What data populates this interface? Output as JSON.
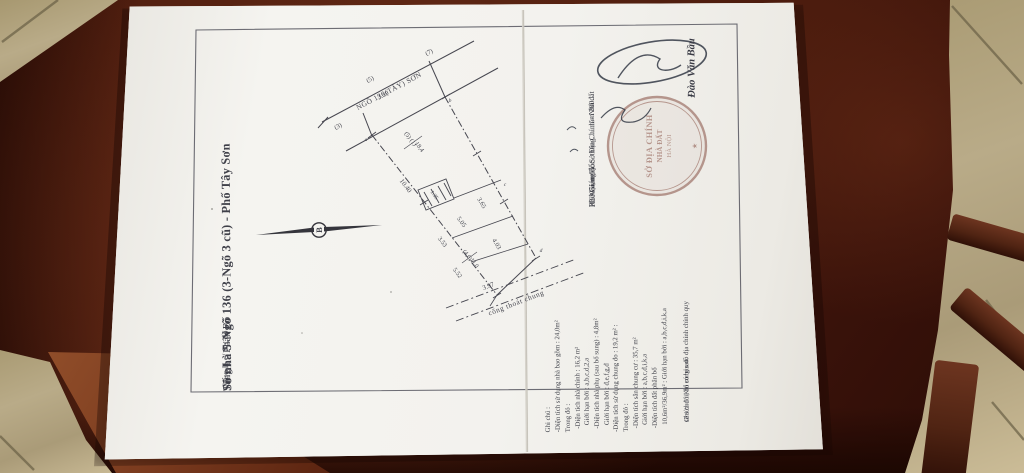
{
  "colors": {
    "table_wood": "#54210f",
    "tile_floor": "#b3a584",
    "paper": "#f4f3ee",
    "print_ink": "#3f4049",
    "handwriting_ink": "#333947",
    "stamp_red": "#8b564a"
  },
  "doc": {
    "section_label": "Mục II c/ Sơ đồ",
    "title": "Số nhà 5-Ngõ 136 (3-Ngõ 3 cũ) - Phố Tây Sơn",
    "subtitle": "Tầng 1 - Phân Bổ",
    "north": "B",
    "road": {
      "name": "NGÕ 136(TÂY) SƠN",
      "n3": "(3)",
      "n5": "(5)",
      "n7": "(7)",
      "dim": "3.39"
    },
    "dims": {
      "d1040": "10.40",
      "lot51": "(5) (1)",
      "a184": "18,4",
      "d365": "3.65",
      "d403": "4.03",
      "d505": "5.05",
      "d353": "3.53",
      "d552": "5.52",
      "lot46": "(4,6)",
      "a110": "11,0",
      "d135": "1.35",
      "d397": "3.97"
    },
    "points": {
      "a": "a",
      "b": "b",
      "c": "c",
      "d": "d"
    },
    "drain_label": "cống thoát chung",
    "notes": {
      "lines": [
        "Ghi chú :",
        "-Diện tích sử dụng nhà bao gồm : 24,0m²",
        "Trong đó :",
        "  -Diện tích nhà chính : 16,2 m²",
        "    Giới hạn bởi : a,b,c,d,2,a",
        "  -Diện tích nhà phụ (sau bổ sung) : 4,8m²",
        "    Giới hạn bởi : đ,e,f,g,đ",
        "-Diện tích sử dụng chung đo : 19,2 m² :",
        "Trong đó :",
        "  -Diện tích sân chung cư : 35,7 m²",
        "    Giới hạn bởi : a,b,c,đ,i,k,a",
        "  -Diện tích đất phân bổ",
        "    10,6m²/36,9m² : Giới hạn bởi : a,b,c,đ,i,k,a"
      ]
    },
    "footnote": {
      "l1": "Ghi chú : Khi có bản đồ địa chính chính quy",
      "l2": "sẽ sửa đổi, bổ sung sau."
    },
    "sign": {
      "date_line": "Hà Nội, ngày......tháng......năm 200...",
      "pos1": "KT/Giám đốc Sở Địa Chính - Nhà đất",
      "pos2": "Phó Giám đốc",
      "name": "Đào Văn Bầu"
    },
    "stamp": {
      "l1": "SỞ ĐỊA CHÍNH",
      "l2": "NHÀ ĐẤT",
      "l3": "HÀ NỘI",
      "star": "★"
    }
  }
}
